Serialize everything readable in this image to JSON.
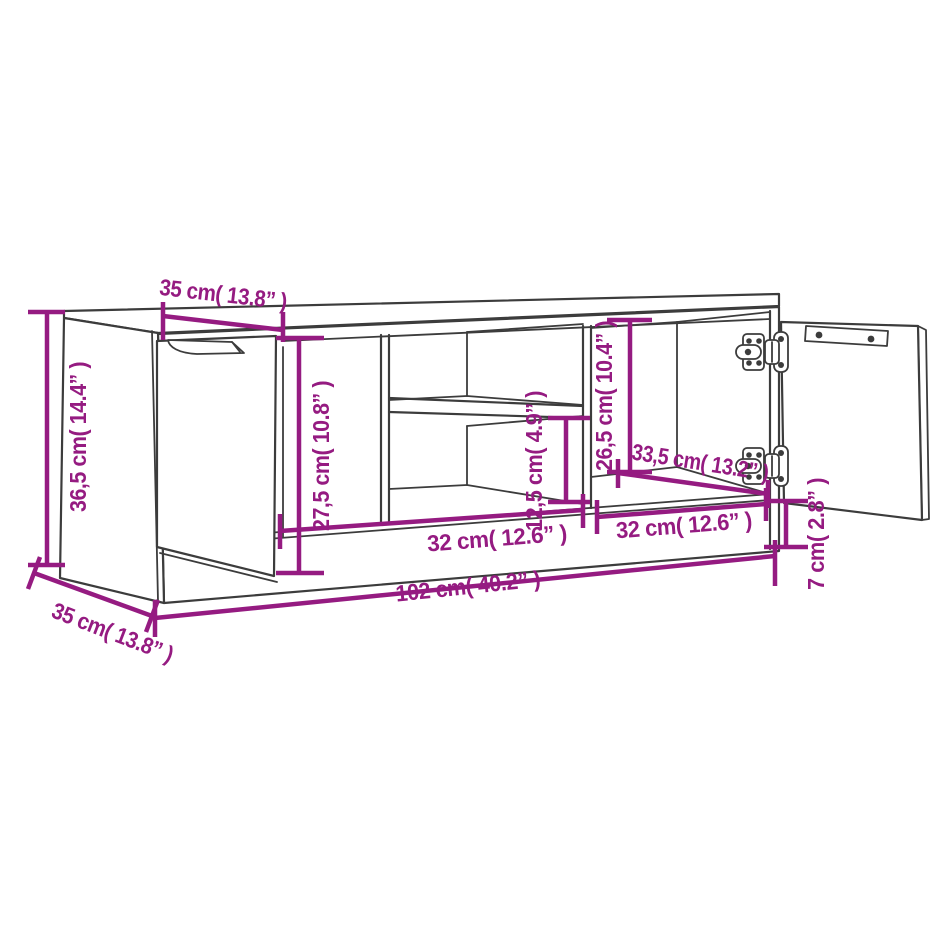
{
  "diagram": {
    "name": "tv-cabinet-dimension-drawing",
    "description": "Line drawing of a TV cabinet with one closed door, open middle shelves and one open door with hinges, annotated with magenta dimension lines",
    "colors": {
      "outline": "#3c3c3c",
      "dimension": "#951b81",
      "background": "#ffffff"
    },
    "dimensions": {
      "overall_height": {
        "label": "36,5 cm( 14.4” )",
        "cm": 36.5,
        "inches": 14.4
      },
      "door_width": {
        "label": "35 cm( 13.8” )",
        "cm": 35,
        "inches": 13.8
      },
      "door_height": {
        "label": "27,5 cm( 10.8” )",
        "cm": 27.5,
        "inches": 10.8
      },
      "open_shelf_height": {
        "label": "12,5 cm( 4.9” )",
        "cm": 12.5,
        "inches": 4.9
      },
      "inner_compartment_height": {
        "label": "26,5 cm( 10.4” )",
        "cm": 26.5,
        "inches": 10.4
      },
      "inner_compartment_depth": {
        "label": "33,5 cm( 13.2” )",
        "cm": 33.5,
        "inches": 13.2
      },
      "left_compartment_width": {
        "label": "32 cm( 12.6” )",
        "cm": 32,
        "inches": 12.6
      },
      "right_compartment_width": {
        "label": "32 cm( 12.6” )",
        "cm": 32,
        "inches": 12.6
      },
      "overall_width": {
        "label": "102 cm( 40.2” )",
        "cm": 102,
        "inches": 40.2
      },
      "plinth_height": {
        "label": "7 cm( 2.8” )",
        "cm": 7,
        "inches": 2.8
      },
      "overall_depth": {
        "label": "35 cm( 13.8” )",
        "cm": 35,
        "inches": 13.8
      }
    }
  }
}
